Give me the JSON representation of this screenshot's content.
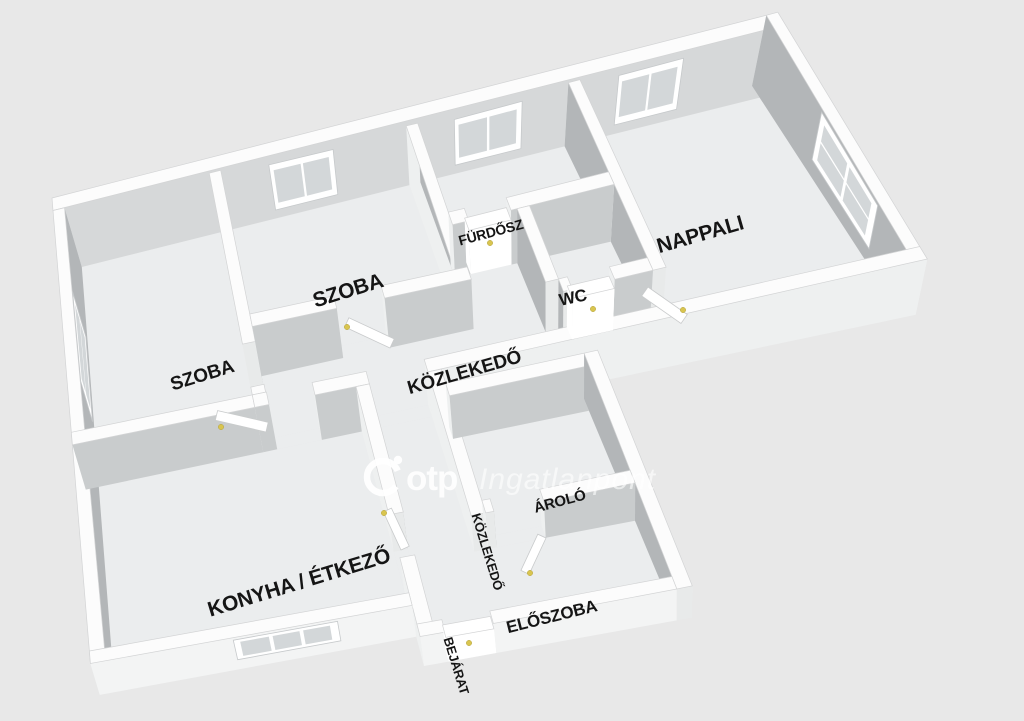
{
  "plan": {
    "rooms": {
      "szoba_left": {
        "label": "SZOBA"
      },
      "szoba_2": {
        "label": "SZOBA"
      },
      "furdoszoba": {
        "label": "FÜRDŐSZ"
      },
      "wc": {
        "label": "WC"
      },
      "nappali": {
        "label": "NAPPALI"
      },
      "kozlekedo": {
        "label": "KÖZLEKEDŐ"
      },
      "konyha_etkezo": {
        "label": "KONYHA / ÉTKEZŐ"
      },
      "kozlekedo_also": {
        "label": "KÖZLEKEDŐ"
      },
      "tarolo": {
        "label": "ÁROLÓ"
      },
      "eloszoba": {
        "label": "ELŐSZOBA"
      }
    },
    "entrance_label": "BEJÁRAT"
  },
  "watermark": {
    "brand": "otp",
    "suffix": "Ingatlanpont"
  },
  "colors": {
    "background": "#e8e8e8",
    "floor": "#ebedee",
    "wall_top": "#fcfcfc",
    "wall_shade": "#b3b6b8",
    "wall_light": "#c9cccd",
    "door_handle": "#d9c54f"
  }
}
